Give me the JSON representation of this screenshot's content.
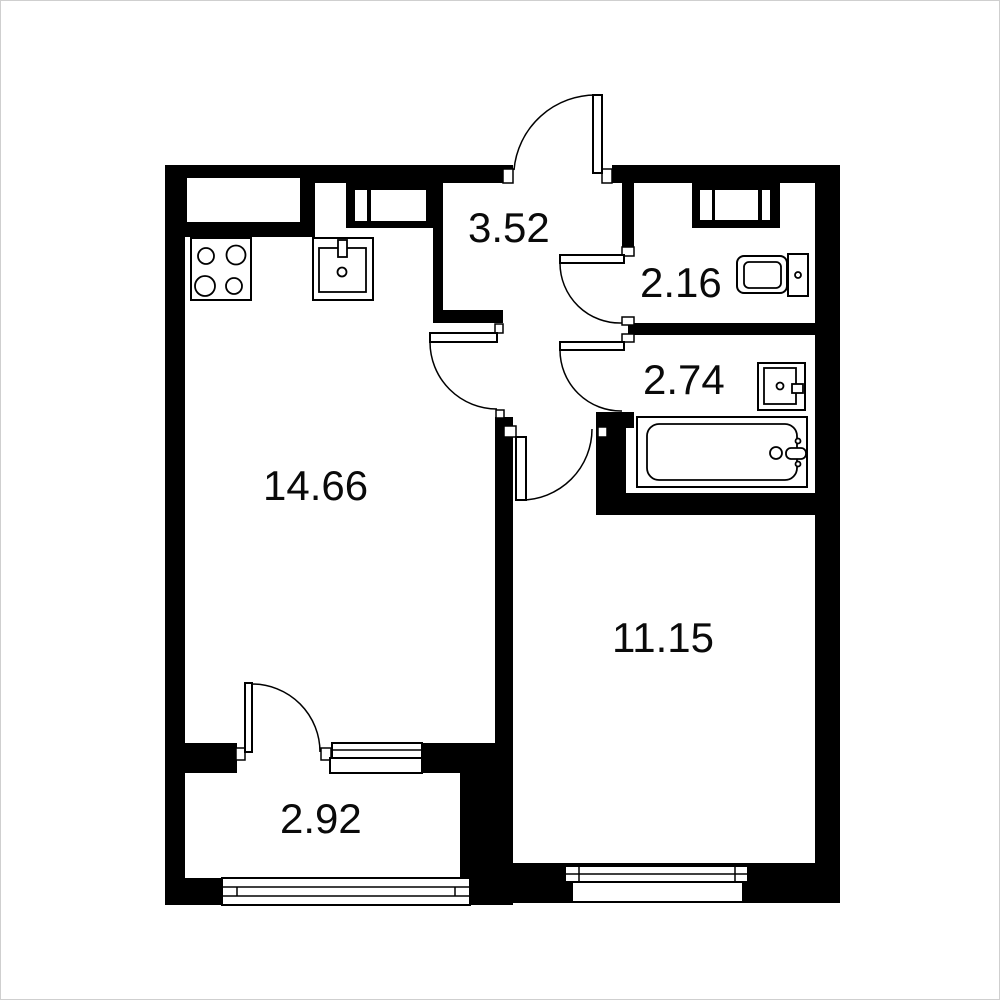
{
  "plan": {
    "title": "apartment floor plan",
    "background_color": "#ffffff",
    "wall_color": "#000000",
    "label_color": "#0a0a0a",
    "rooms": [
      {
        "name": "kitchen-living-room",
        "area": "14.66"
      },
      {
        "name": "hallway",
        "area": "3.52"
      },
      {
        "name": "toilet",
        "area": "2.16"
      },
      {
        "name": "bathroom",
        "area": "2.74"
      },
      {
        "name": "room",
        "area": "11.15"
      },
      {
        "name": "balcony",
        "area": "2.92"
      }
    ],
    "fixtures": [
      "stove-icon",
      "kitchen-sink-icon",
      "toilet-icon",
      "washbasin-icon",
      "bathtub-icon",
      "vent-shaft-icon"
    ]
  }
}
